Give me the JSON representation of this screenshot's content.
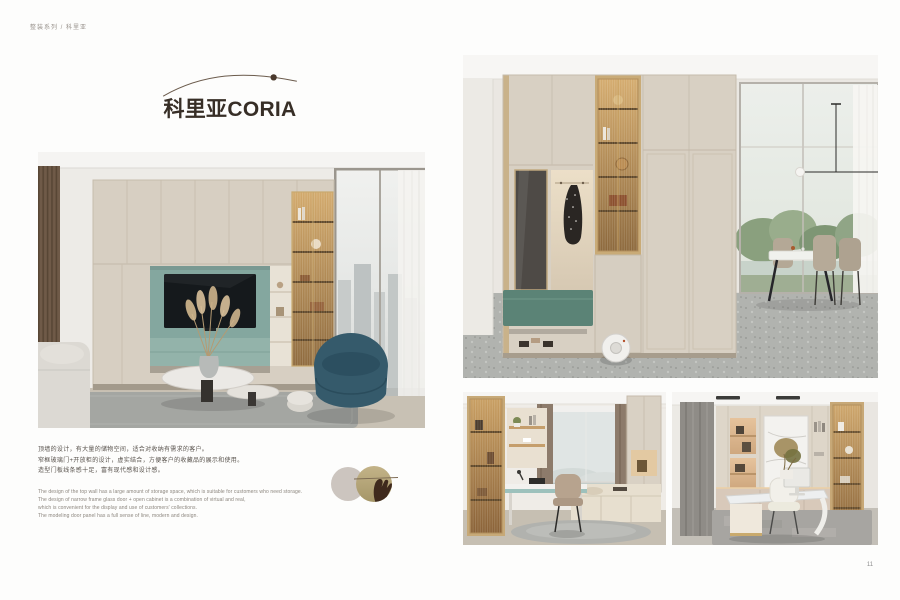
{
  "header": {
    "breadcrumb": "整装系列 / 科里亚"
  },
  "title": {
    "cn": "科里亚",
    "en": "CORIA"
  },
  "intro": {
    "cn_lines": [
      "顶墙的设计，有大量的储物空间，适合对收纳有需求的客户。",
      "窄框玻璃门+开放柜的设计，虚实结合，方便客户的收藏品的展示和使用。",
      "造型门板线条感十足，富有现代感和设计感。"
    ],
    "en_lines": [
      "The design of the top wall has a large amount of storage space, which is suitable for customers who need storage.",
      "The design of narrow frame glass door + open cabinet is a combination of virtual and real,",
      "which is convenient for the display and use of customers' collections.",
      "The modeling door panel has a full sense of line, modern and design."
    ]
  },
  "page_number": "11",
  "palette": {
    "cabinet_beige": "#D7CFC2",
    "accent_teal": "#84A79F",
    "display_amber": "#C29A63",
    "bench_green": "#5B8376",
    "title_ink": "#372E26"
  }
}
